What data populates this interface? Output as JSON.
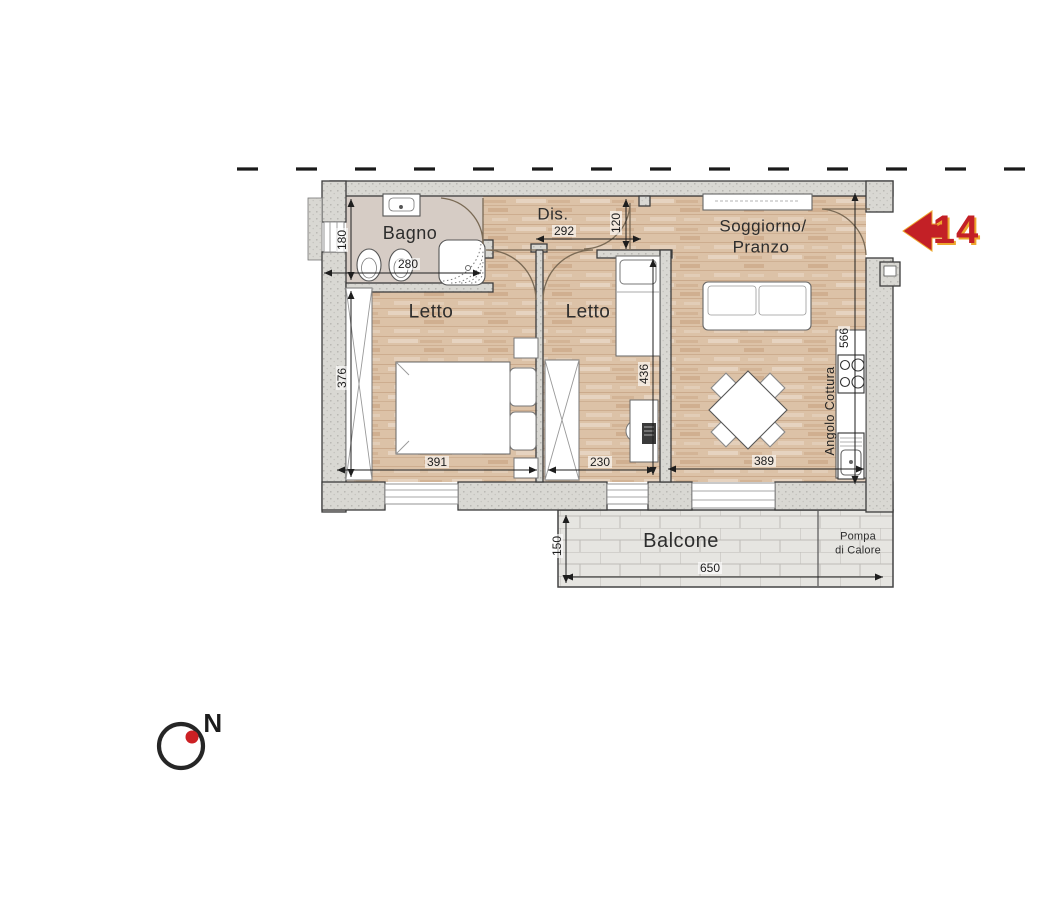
{
  "marker": {
    "number": "14"
  },
  "compass": {
    "label": "N"
  },
  "rooms": {
    "bagno": "Bagno",
    "dis": "Dis.",
    "letto_left": "Letto",
    "letto_center": "Letto",
    "soggiorno_line1": "Soggiorno/",
    "soggiorno_line2": "Pranzo",
    "balcone": "Balcone",
    "angolo_cottura": "Angolo Cottura",
    "pompa_line1": "Pompa",
    "pompa_line2": "di Calore"
  },
  "dims": {
    "bagno_h": "180",
    "bagno_w": "280",
    "dis_w": "292",
    "dis_door": "120",
    "letto_left_h": "376",
    "letto_left_w": "391",
    "letto_center_w": "230",
    "letto_center_h": "436",
    "sog_w": "389",
    "sog_h": "566",
    "balcone_w": "650",
    "balcone_d": "150"
  },
  "colors": {
    "arrow_red": "#c32026",
    "arrow_outline": "#eda72e",
    "compass_dot": "#cc2024",
    "wood_floor": "#dcc2a7",
    "bagno_floor": "#d6ccc5",
    "wall_gray": "#d9d8d3"
  }
}
